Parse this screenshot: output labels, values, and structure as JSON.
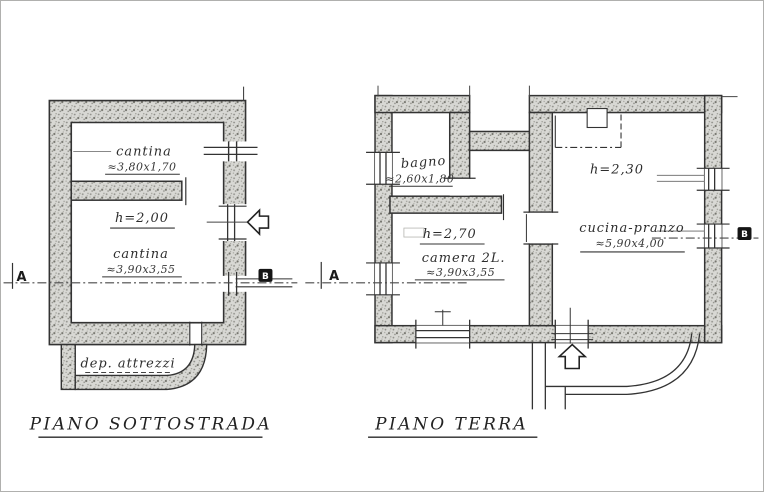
{
  "plans": {
    "sottostrada": {
      "title": "PIANO SOTTOSTRADA",
      "labels": {
        "cantina1_name": "cantina",
        "cantina1_dim": "≈3,80x1,70",
        "height": "h=2,00",
        "cantina2_name": "cantina",
        "cantina2_dim": "≈3,90x3,55",
        "deposito_name": "dep. attrezzi",
        "marker_a": "A",
        "marker_b": "B"
      }
    },
    "terra": {
      "title": "PIANO TERRA",
      "labels": {
        "bagno_name": "bagno",
        "bagno_dim": "≈2,60x1,80",
        "camera_height": "h=2,70",
        "camera_name": "camera 2L.",
        "camera_dim": "≈3,90x3,55",
        "cucina_height": "h=2,30",
        "cucina_name": "cucina-pranzo",
        "cucina_dim": "≈5,90x4,00",
        "marker_a": "A",
        "marker_b": "B"
      }
    }
  },
  "colors": {
    "paper": "#ffffff",
    "ink": "#2e2e2e",
    "wall_fill": "#c8c8c4"
  }
}
